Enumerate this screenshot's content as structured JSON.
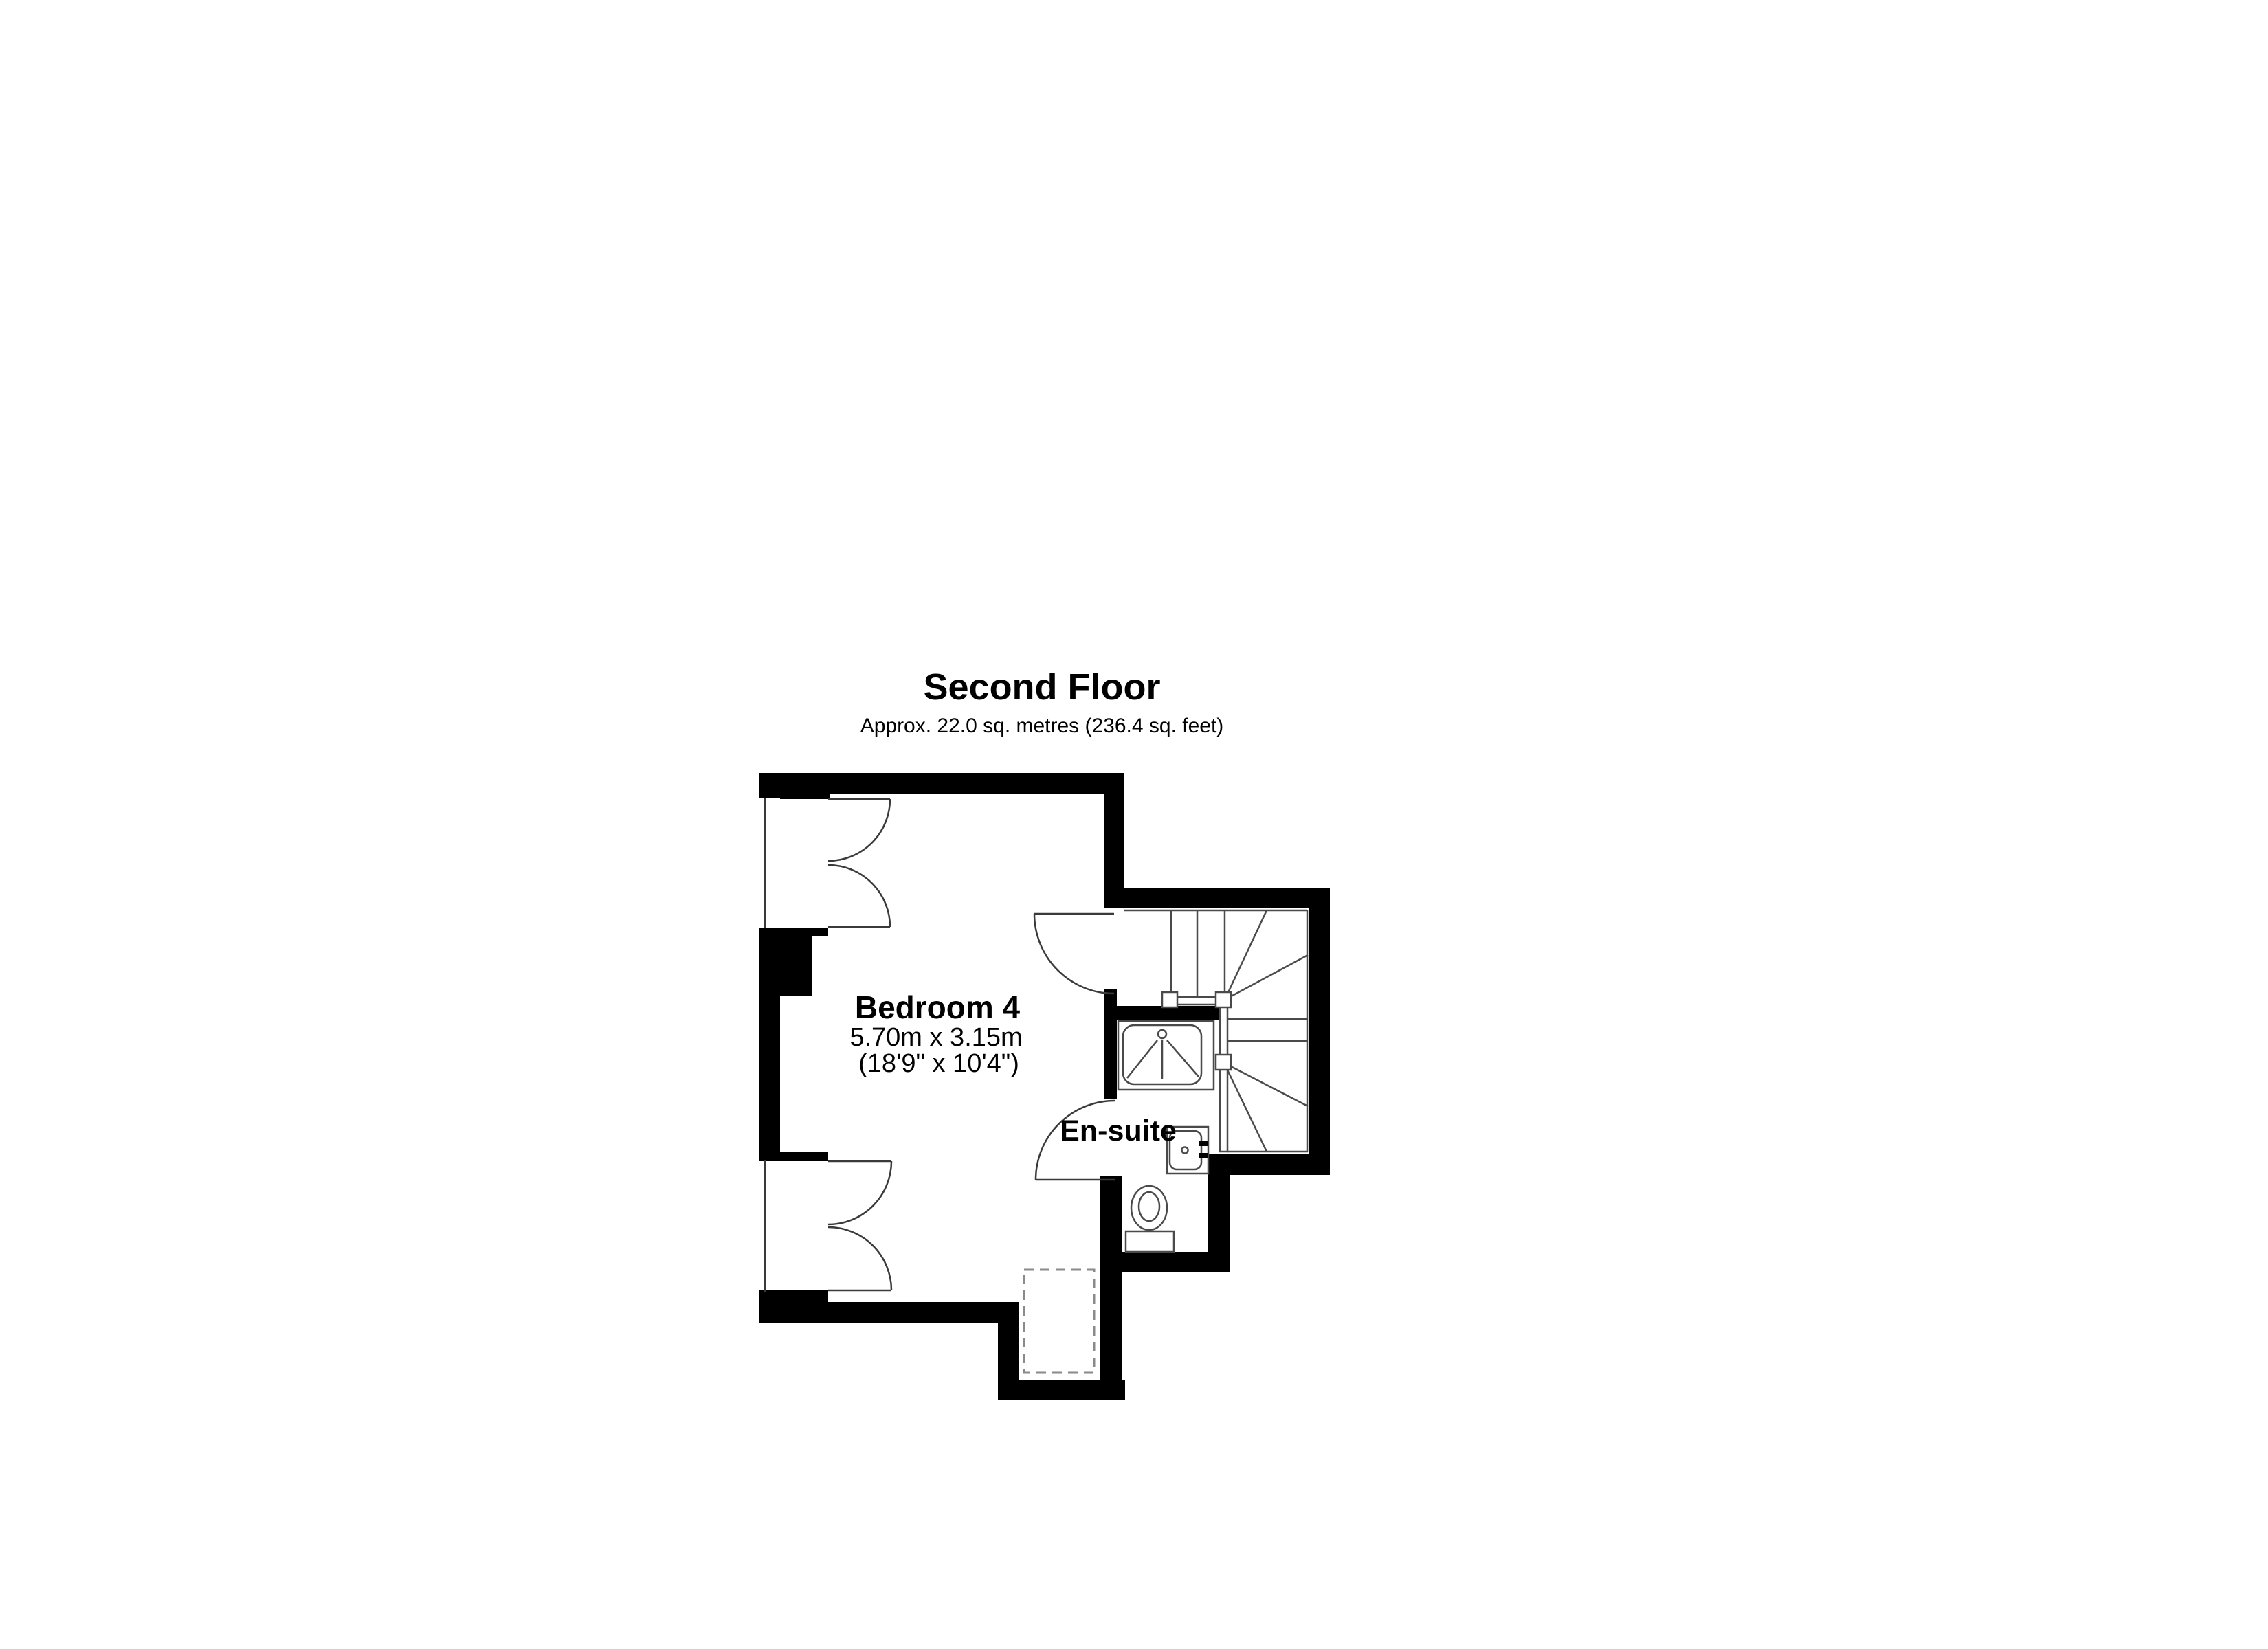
{
  "floor_plan": {
    "title": "Second Floor",
    "area_note": "Approx. 22.0 sq. metres (236.4 sq. feet)"
  },
  "rooms": {
    "bedroom4": {
      "label": "Bedroom 4",
      "size_metric": "5.70m x 3.15m",
      "size_imperial": "(18'9\" x 10'4\")"
    },
    "ensuite": {
      "label": "En-suite"
    }
  },
  "colors": {
    "walls": "#000000",
    "doors": "#3a3a3a",
    "fixtures": "#4a4a4a",
    "stairs": "#4a4a4a",
    "dashed_outline": "#8a8a8a",
    "background": "#ffffff"
  }
}
